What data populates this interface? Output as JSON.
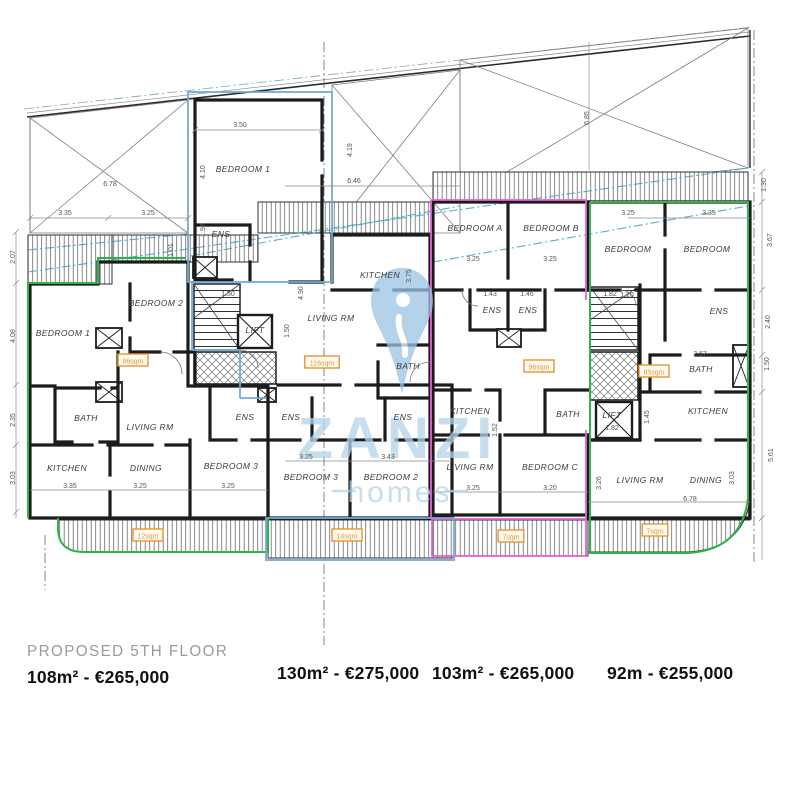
{
  "footer": {
    "floor_label": "PROPOSED 5TH FLOOR",
    "prices": [
      "108m² - €265,000",
      "130m² - €275,000",
      "103m² - €265,000",
      "92m - €255,000"
    ]
  },
  "watermark": {
    "brand": "ZANZI",
    "sub": "homes"
  },
  "colors": {
    "unit_green": "#2eb34d",
    "unit_magenta": "#ea5fd8",
    "unit_blue": "#74aad6",
    "airspace_cyan": "#3d9ec4",
    "badge_orange": "#e8952f",
    "watermark_blue": "#aecfe8",
    "wall_black": "#1c1c1c"
  },
  "plan": {
    "rooms": [
      {
        "label": "BEDROOM 1",
        "x": 63,
        "y": 336
      },
      {
        "label": "BEDROOM 2",
        "x": 156,
        "y": 306
      },
      {
        "label": "BATH",
        "x": 86,
        "y": 421
      },
      {
        "label": "LIVING RM",
        "x": 150,
        "y": 430
      },
      {
        "label": "KITCHEN",
        "x": 67,
        "y": 471
      },
      {
        "label": "DINING",
        "x": 146,
        "y": 471
      },
      {
        "label": "ENS",
        "x": 245,
        "y": 420
      },
      {
        "label": "BEDROOM 3",
        "x": 231,
        "y": 469
      },
      {
        "label": "BEDROOM 1",
        "x": 243,
        "y": 172
      },
      {
        "label": "ENS",
        "x": 221,
        "y": 237
      },
      {
        "label": "KITCHEN",
        "x": 380,
        "y": 278
      },
      {
        "label": "LIVING RM",
        "x": 331,
        "y": 321
      },
      {
        "label": "BATH",
        "x": 408,
        "y": 369
      },
      {
        "label": "ENS",
        "x": 291,
        "y": 420
      },
      {
        "label": "ENS",
        "x": 403,
        "y": 420
      },
      {
        "label": "BEDROOM 3",
        "x": 311,
        "y": 480
      },
      {
        "label": "BEDROOM 2",
        "x": 391,
        "y": 480
      },
      {
        "label": "BEDROOM A",
        "x": 475,
        "y": 231
      },
      {
        "label": "BEDROOM B",
        "x": 551,
        "y": 231
      },
      {
        "label": "ENS",
        "x": 492,
        "y": 313
      },
      {
        "label": "ENS",
        "x": 528,
        "y": 313
      },
      {
        "label": "KITCHEN",
        "x": 470,
        "y": 414
      },
      {
        "label": "LIVING RM",
        "x": 470,
        "y": 470
      },
      {
        "label": "BATH",
        "x": 568,
        "y": 417
      },
      {
        "label": "BEDROOM C",
        "x": 550,
        "y": 470
      },
      {
        "label": "BEDROOM",
        "x": 628,
        "y": 252
      },
      {
        "label": "BEDROOM",
        "x": 707,
        "y": 252
      },
      {
        "label": "ENS",
        "x": 719,
        "y": 314
      },
      {
        "label": "BATH",
        "x": 701,
        "y": 372
      },
      {
        "label": "KITCHEN",
        "x": 708,
        "y": 414
      },
      {
        "label": "LIVING RM",
        "x": 640,
        "y": 483
      },
      {
        "label": "DINING",
        "x": 706,
        "y": 483
      },
      {
        "label": "LIFT",
        "x": 255,
        "y": 333
      },
      {
        "label": "LIFT",
        "x": 612,
        "y": 418
      }
    ],
    "dimensions": [
      {
        "v": "6.78",
        "x": 110,
        "y": 186,
        "rot": 0
      },
      {
        "v": "3.35",
        "x": 65,
        "y": 215,
        "rot": 0
      },
      {
        "v": "3.25",
        "x": 148,
        "y": 215,
        "rot": 0
      },
      {
        "v": "6.46",
        "x": 354,
        "y": 183,
        "rot": 0
      },
      {
        "v": "4.19",
        "x": 352,
        "y": 150,
        "rot": 90
      },
      {
        "v": "6.85",
        "x": 589,
        "y": 118,
        "rot": 90
      },
      {
        "v": "3.50",
        "x": 240,
        "y": 127,
        "rot": 0
      },
      {
        "v": "4.10",
        "x": 205,
        "y": 172,
        "rot": 90
      },
      {
        "v": "1.98",
        "x": 205,
        "y": 230,
        "rot": 90
      },
      {
        "v": "1.01",
        "x": 173,
        "y": 250,
        "rot": 90
      },
      {
        "v": "2.07",
        "x": 15,
        "y": 257,
        "rot": 90
      },
      {
        "v": "4.08",
        "x": 15,
        "y": 336,
        "rot": 90
      },
      {
        "v": "2.35",
        "x": 15,
        "y": 420,
        "rot": 90
      },
      {
        "v": "3.03",
        "x": 15,
        "y": 478,
        "rot": 90
      },
      {
        "v": "1.50",
        "x": 228,
        "y": 296,
        "rot": 0
      },
      {
        "v": "1.50",
        "x": 289,
        "y": 331,
        "rot": 90
      },
      {
        "v": "4.90",
        "x": 303,
        "y": 293,
        "rot": 90
      },
      {
        "v": "3.75",
        "x": 411,
        "y": 276,
        "rot": 90
      },
      {
        "v": "3.25",
        "x": 306,
        "y": 459,
        "rot": 0
      },
      {
        "v": "3.43",
        "x": 388,
        "y": 459,
        "rot": 0
      },
      {
        "v": "3.35",
        "x": 70,
        "y": 488,
        "rot": 0
      },
      {
        "v": "3.25",
        "x": 140,
        "y": 488,
        "rot": 0
      },
      {
        "v": "3.25",
        "x": 228,
        "y": 488,
        "rot": 0
      },
      {
        "v": "3.25",
        "x": 473,
        "y": 261,
        "rot": 0
      },
      {
        "v": "3.25",
        "x": 550,
        "y": 261,
        "rot": 0
      },
      {
        "v": "1.43",
        "x": 490,
        "y": 296,
        "rot": 0
      },
      {
        "v": "1.46",
        "x": 527,
        "y": 296,
        "rot": 0
      },
      {
        "v": "1.52",
        "x": 497,
        "y": 430,
        "rot": 90
      },
      {
        "v": "3.25",
        "x": 473,
        "y": 490,
        "rot": 0
      },
      {
        "v": "3.20",
        "x": 550,
        "y": 490,
        "rot": 0
      },
      {
        "v": "3.25",
        "x": 628,
        "y": 215,
        "rot": 0
      },
      {
        "v": "3.35",
        "x": 709,
        "y": 215,
        "rot": 0
      },
      {
        "v": "1.20",
        "x": 627,
        "y": 297,
        "rot": 0
      },
      {
        "v": "2.67",
        "x": 700,
        "y": 356,
        "rot": 0
      },
      {
        "v": "1.45",
        "x": 649,
        "y": 417,
        "rot": 90
      },
      {
        "v": "1.82",
        "x": 610,
        "y": 296,
        "rot": 0
      },
      {
        "v": "1.82",
        "x": 612,
        "y": 430,
        "rot": 0
      },
      {
        "v": "3.26",
        "x": 601,
        "y": 483,
        "rot": 90
      },
      {
        "v": "3.03",
        "x": 734,
        "y": 478,
        "rot": 90
      },
      {
        "v": "6.78",
        "x": 690,
        "y": 501,
        "rot": 0
      },
      {
        "v": "5.61",
        "x": 773,
        "y": 455,
        "rot": 90
      },
      {
        "v": "1.30",
        "x": 766,
        "y": 185,
        "rot": 90
      },
      {
        "v": "3.67",
        "x": 772,
        "y": 240,
        "rot": 90
      },
      {
        "v": "2.40",
        "x": 770,
        "y": 322,
        "rot": 90
      },
      {
        "v": "1.50",
        "x": 769,
        "y": 364,
        "rot": 90
      }
    ],
    "area_badges": [
      {
        "label": "96sqm",
        "x": 133,
        "y": 361
      },
      {
        "label": "116sqm",
        "x": 322,
        "y": 363
      },
      {
        "label": "96sqm",
        "x": 539,
        "y": 367
      },
      {
        "label": "85sqm",
        "x": 654,
        "y": 372
      },
      {
        "label": "12sqm",
        "x": 148,
        "y": 536
      },
      {
        "label": "14sqm",
        "x": 347,
        "y": 536
      },
      {
        "label": "7sqm",
        "x": 511,
        "y": 537
      },
      {
        "label": "7sqm",
        "x": 655,
        "y": 531
      }
    ]
  }
}
